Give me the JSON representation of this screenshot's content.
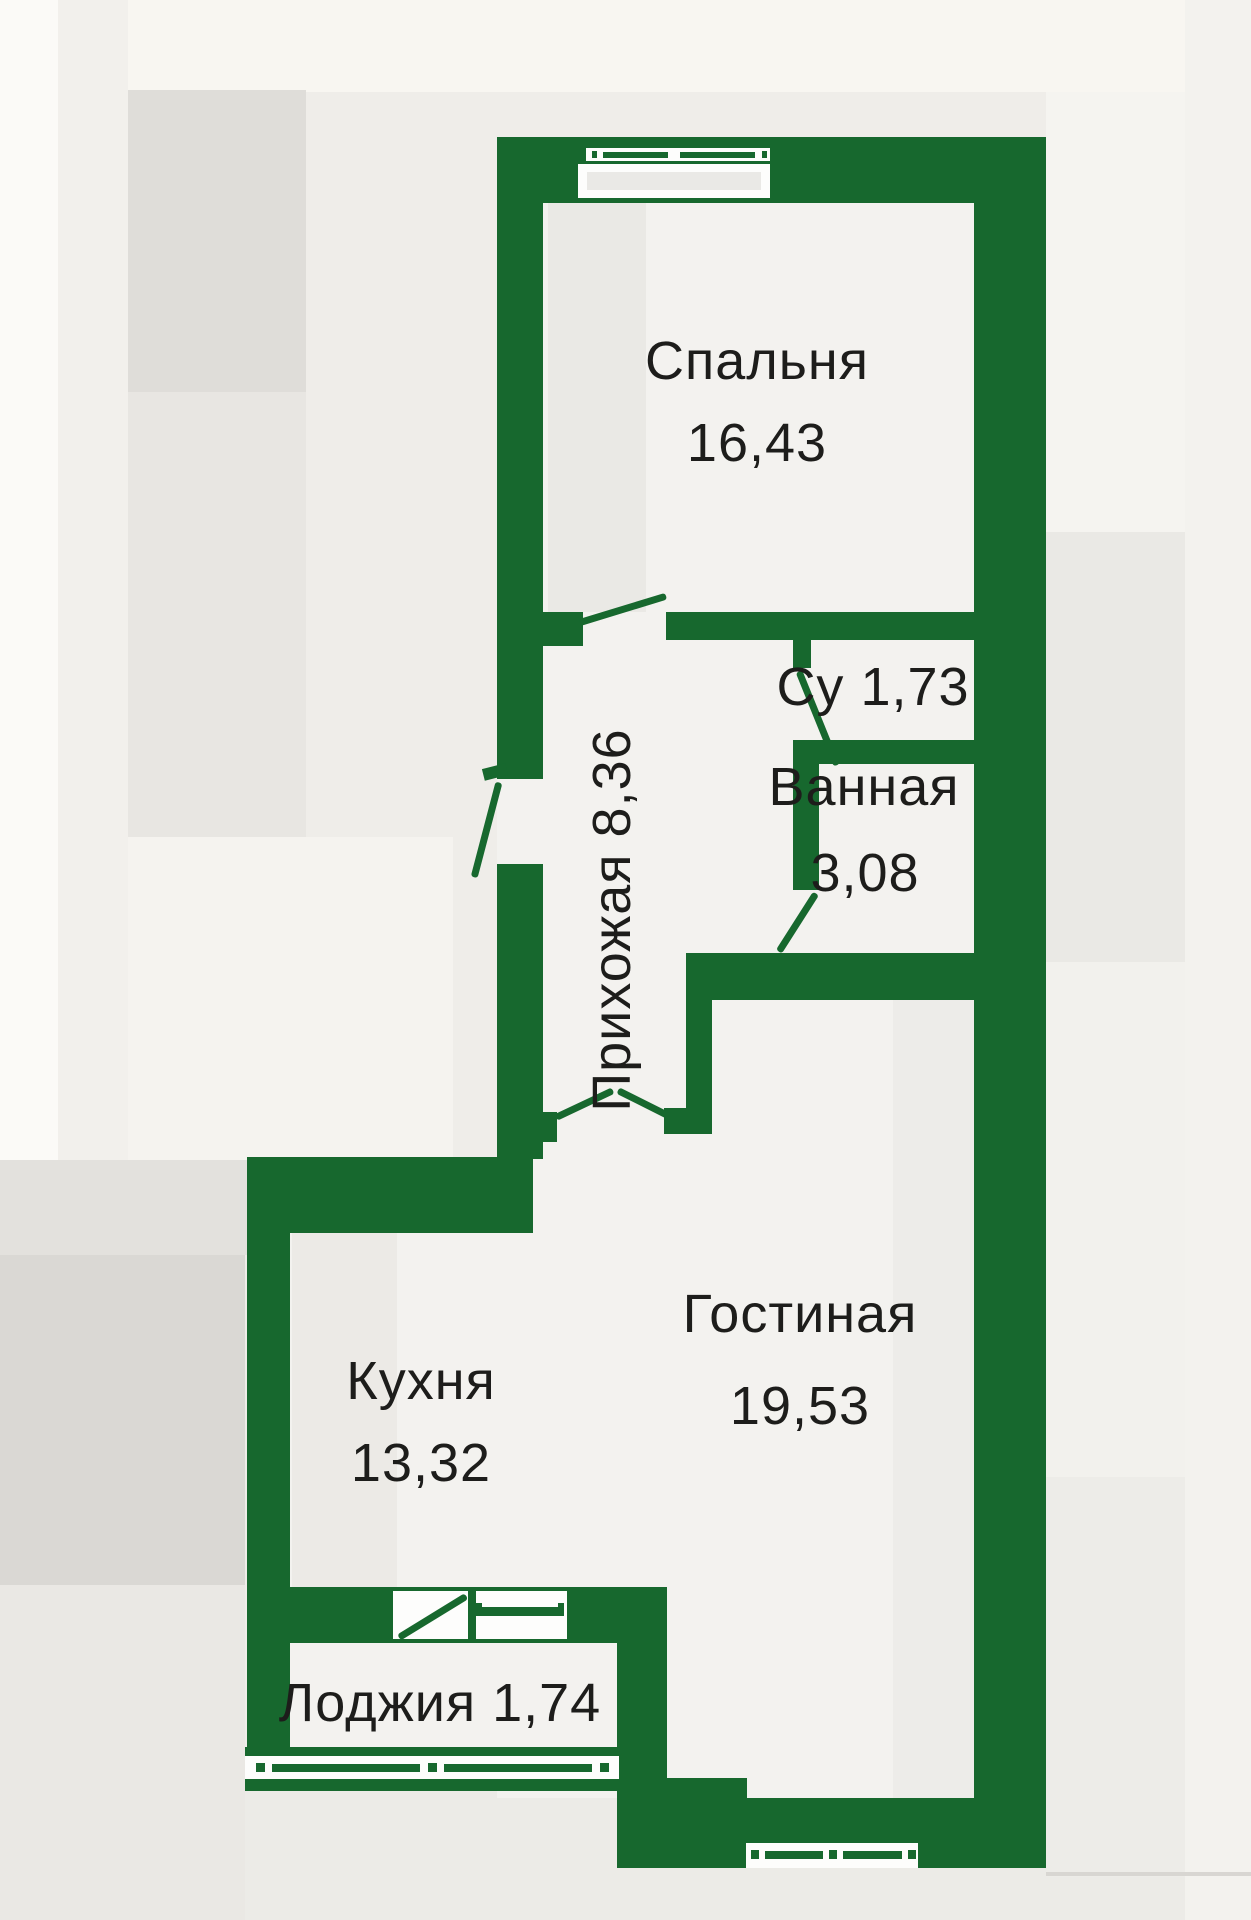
{
  "image_type": "apartment floor plan drawing",
  "colors": {
    "wall_green": "#17682e",
    "label_ink": "#1d1d1b",
    "floor": "#f3f2ef",
    "canvas": "#efede9"
  },
  "rooms": [
    {
      "key": "bedroom",
      "name": "Спальня",
      "area": "16,43"
    },
    {
      "key": "su",
      "name": "Су",
      "area": "1,73"
    },
    {
      "key": "bathroom",
      "name": "Ванная",
      "area": "3,08"
    },
    {
      "key": "hallway",
      "name": "Прихожая",
      "area": "8,36"
    },
    {
      "key": "kitchen",
      "name": "Кухня",
      "area": "13,32"
    },
    {
      "key": "living_room",
      "name": "Гостиная",
      "area": "19,53"
    },
    {
      "key": "loggia",
      "name": "Лоджия",
      "area": "1,74"
    }
  ]
}
